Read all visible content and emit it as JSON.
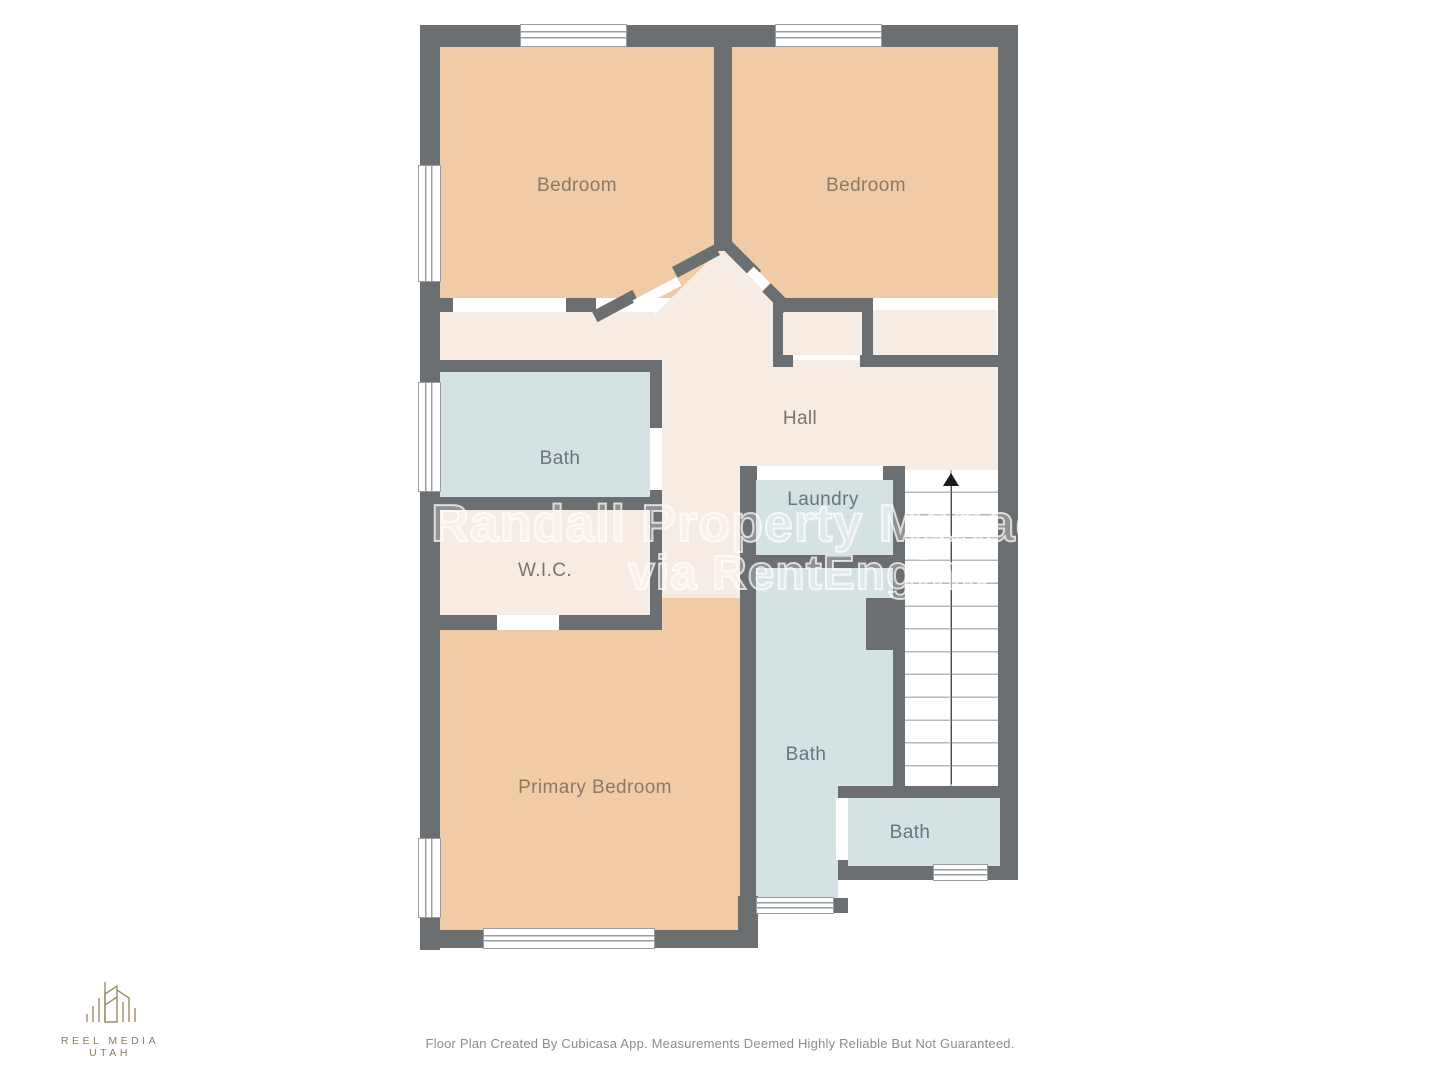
{
  "watermark": {
    "line1": "n Randall Property Manageme",
    "line2": "via RentEngine"
  },
  "footer": {
    "disclaimer": "Floor Plan Created By Cubicasa App. Measurements Deemed Highly Reliable But Not Guaranteed."
  },
  "logo": {
    "text": "REEL MEDIA UTAH"
  },
  "floorplan": {
    "colors": {
      "wall": "#6b6f72",
      "bedroom_fill": "#f0cba6",
      "bath_fill": "#d4e2e4",
      "hall_fill": "#f7ece3",
      "stairs_fill": "#ffffff",
      "window_border": "#9a9da0",
      "label_warm": "#8c7a66",
      "label_cool": "#64767f",
      "label_neutral": "#7d7468",
      "logo_gold": "#9d8c60"
    },
    "stairs": {
      "direction": "up",
      "steps": 14
    },
    "rooms": [
      {
        "id": "bedroom-left",
        "label": "Bedroom"
      },
      {
        "id": "bedroom-right",
        "label": "Bedroom"
      },
      {
        "id": "bath-upper",
        "label": "Bath"
      },
      {
        "id": "hall",
        "label": "Hall"
      },
      {
        "id": "laundry",
        "label": "Laundry"
      },
      {
        "id": "wic",
        "label": "W.I.C."
      },
      {
        "id": "primary-bedroom",
        "label": "Primary Bedroom"
      },
      {
        "id": "bath-middle",
        "label": "Bath"
      },
      {
        "id": "bath-lower-right",
        "label": "Bath"
      }
    ]
  }
}
